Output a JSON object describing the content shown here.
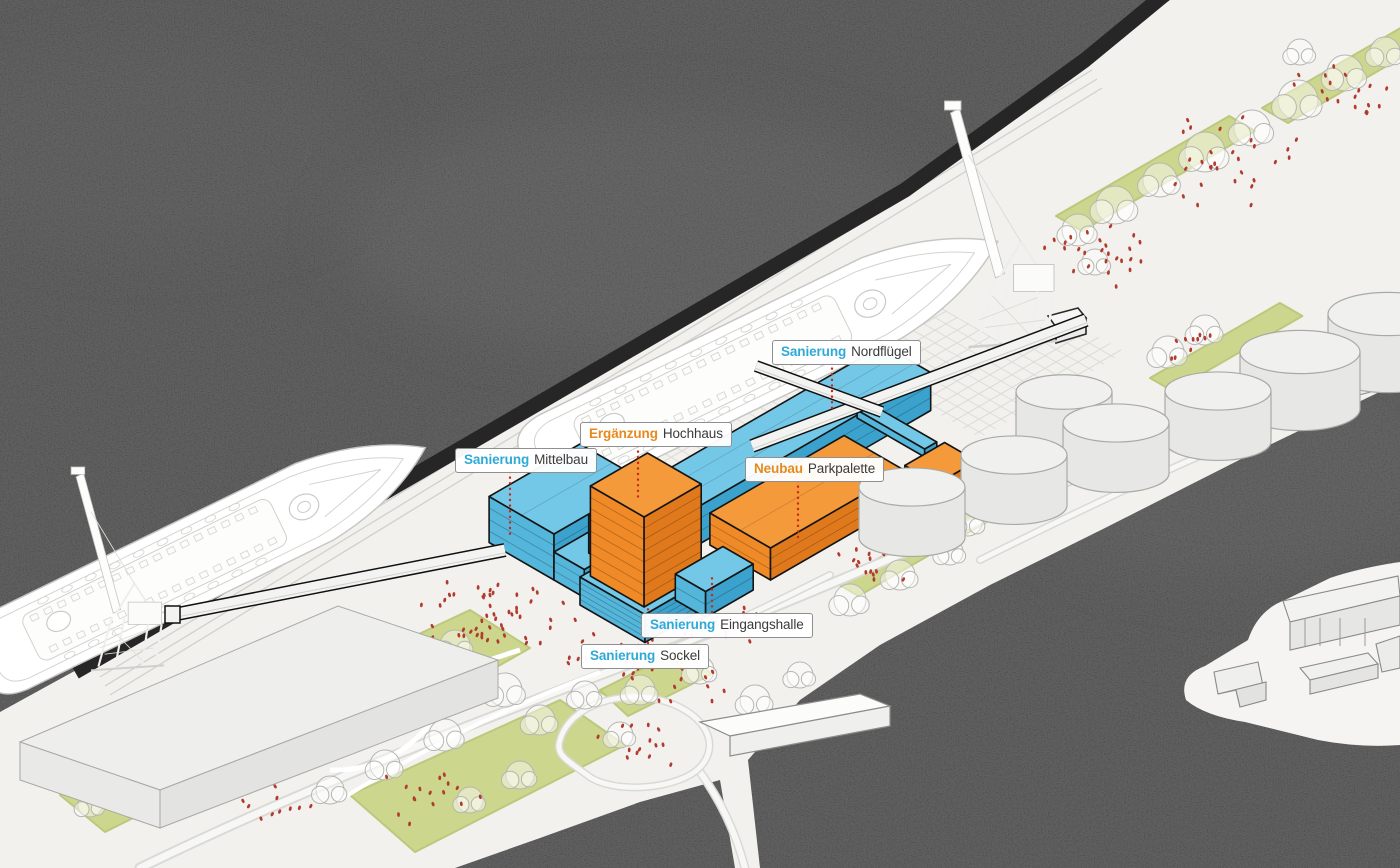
{
  "meta": {
    "description": "Axonometric harbor site diagram of a cruise terminal with renovation (blue) and new construction (orange) buildings, two ghosted cruise ships, harbor cranes, storage tanks and landscaped quays.",
    "language": "de"
  },
  "colors": {
    "water": "#3b3b3b",
    "land": "#f2f1ee",
    "green": "#ccd68d",
    "green_edge": "#bcc87c",
    "renovation_accent": "#2fa9d6",
    "new_accent": "#e68a1e",
    "renovation_top": "#74c8e7",
    "renovation_side_left": "#54b6db",
    "renovation_side_right": "#3aa2cc",
    "new_top": "#f49a3a",
    "new_side_left": "#ef8a27",
    "new_side_right": "#e0791c",
    "people": "#b23b2e",
    "leader": "#c8281c",
    "outline": "#151515",
    "label_text": "#3b3b3b",
    "label_bg": "#ffffff",
    "label_border": "#8f8f8f",
    "quay_edge": "#262626",
    "ghost_stroke": "#c6c6c3"
  },
  "labels": [
    {
      "id": "nordfluegel",
      "keyword": "Sanierung",
      "name": "Nordflügel",
      "category": "renovation"
    },
    {
      "id": "hochhaus",
      "keyword": "Ergänzung",
      "name": "Hochhaus",
      "category": "new"
    },
    {
      "id": "mittelbau",
      "keyword": "Sanierung",
      "name": "Mittelbau",
      "category": "renovation"
    },
    {
      "id": "parkpalette",
      "keyword": "Neubau",
      "name": "Parkpalette",
      "category": "new"
    },
    {
      "id": "eingangshalle",
      "keyword": "Sanierung",
      "name": "Eingangshalle",
      "category": "renovation"
    },
    {
      "id": "sockel",
      "keyword": "Sanierung",
      "name": "Sockel",
      "category": "renovation"
    }
  ],
  "scene": {
    "ships_count": 2,
    "cranes_count": 2,
    "storage_tanks_count": 7,
    "callouts_count": 6
  }
}
